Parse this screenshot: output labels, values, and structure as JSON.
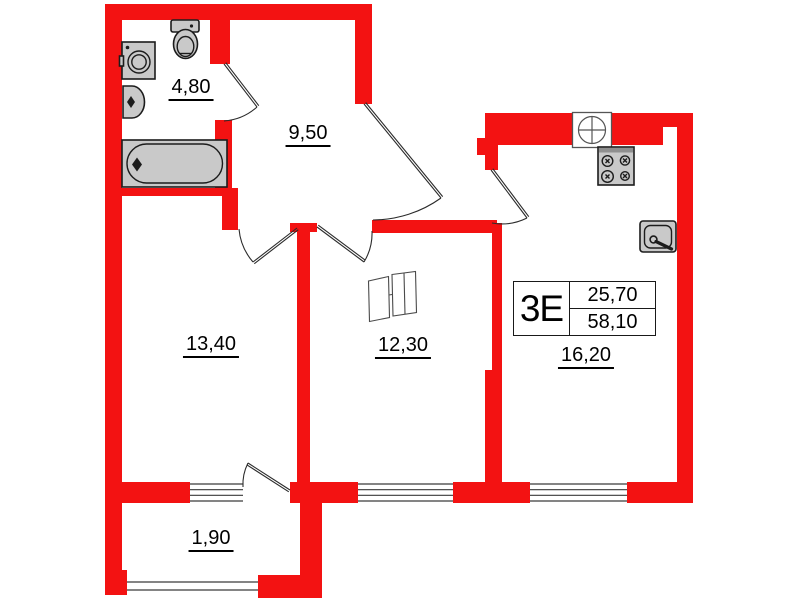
{
  "unit": {
    "type": "3Е",
    "area_top": "25,70",
    "area_bottom": "58,10"
  },
  "rooms": [
    {
      "id": "bathroom",
      "area": "4,80"
    },
    {
      "id": "hallway",
      "area": "9,50"
    },
    {
      "id": "bedroom",
      "area": "13,40"
    },
    {
      "id": "room-2",
      "area": "12,30"
    },
    {
      "id": "kitchen-living-room",
      "area": "16,20"
    },
    {
      "id": "balcony",
      "area": "1,90"
    }
  ],
  "fixtures": [
    "toilet",
    "washing-machine",
    "wash-basin",
    "bathtub",
    "stove",
    "kitchen-sink",
    "ventilation-shaft",
    "wardrobe"
  ],
  "colors": {
    "wall": "#f31212",
    "fixture-fill": "#c9c9c9",
    "fixture-stroke": "#1c1c1c",
    "line": "#3a3a3a"
  }
}
